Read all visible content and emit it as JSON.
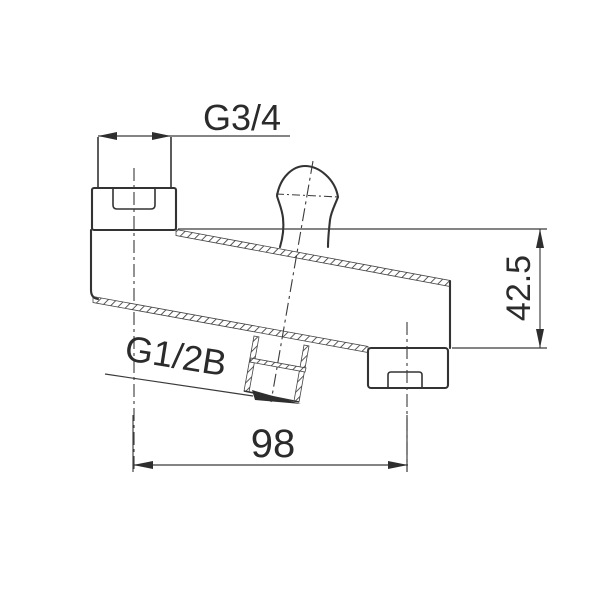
{
  "page": {
    "background": "#ffffff"
  },
  "drawing": {
    "kind": "bath-spout-dimensional-drawing",
    "line_color": "#333333",
    "labels": {
      "top_thread": "G3/4",
      "outlet_thread": "G1/2B",
      "length_mm": "98",
      "height_mm": "42.5"
    }
  }
}
